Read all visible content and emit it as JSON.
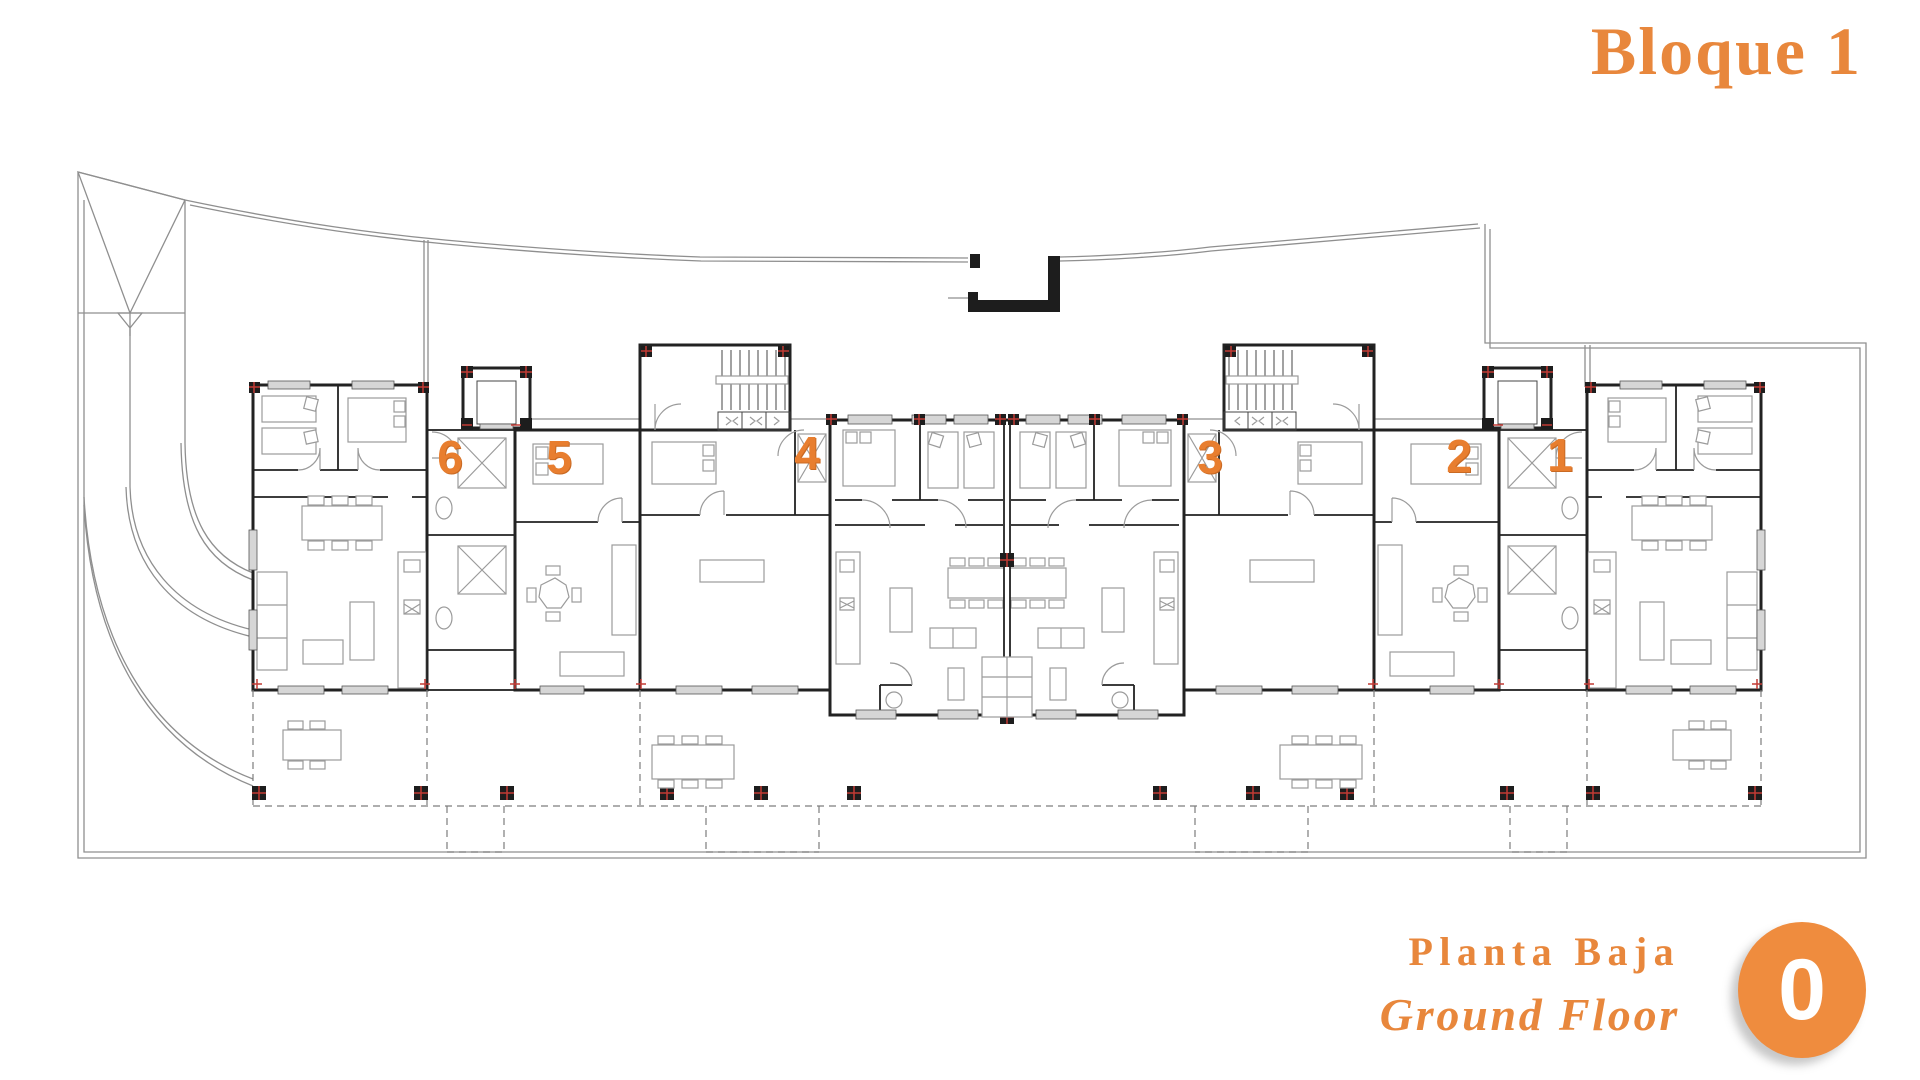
{
  "header": {
    "block_title": "Bloque 1"
  },
  "plan": {
    "type": "architectural-floor-plan",
    "building": "Bloque 1",
    "floor": "Planta Baja / Ground Floor",
    "unit_labels": [
      "6",
      "5",
      "4",
      "3",
      "2",
      "1"
    ]
  },
  "footer": {
    "floor_name_es": "Planta Baja",
    "floor_name_en": "Ground Floor",
    "floor_number": "0"
  },
  "colors": {
    "accent_text": "#E8873C",
    "unit_number": "#E87E2F",
    "badge_fill": "#EF8C3E",
    "wall_line": "#222222",
    "site_line": "#8f8f8f",
    "marker_red": "#C23B35"
  }
}
